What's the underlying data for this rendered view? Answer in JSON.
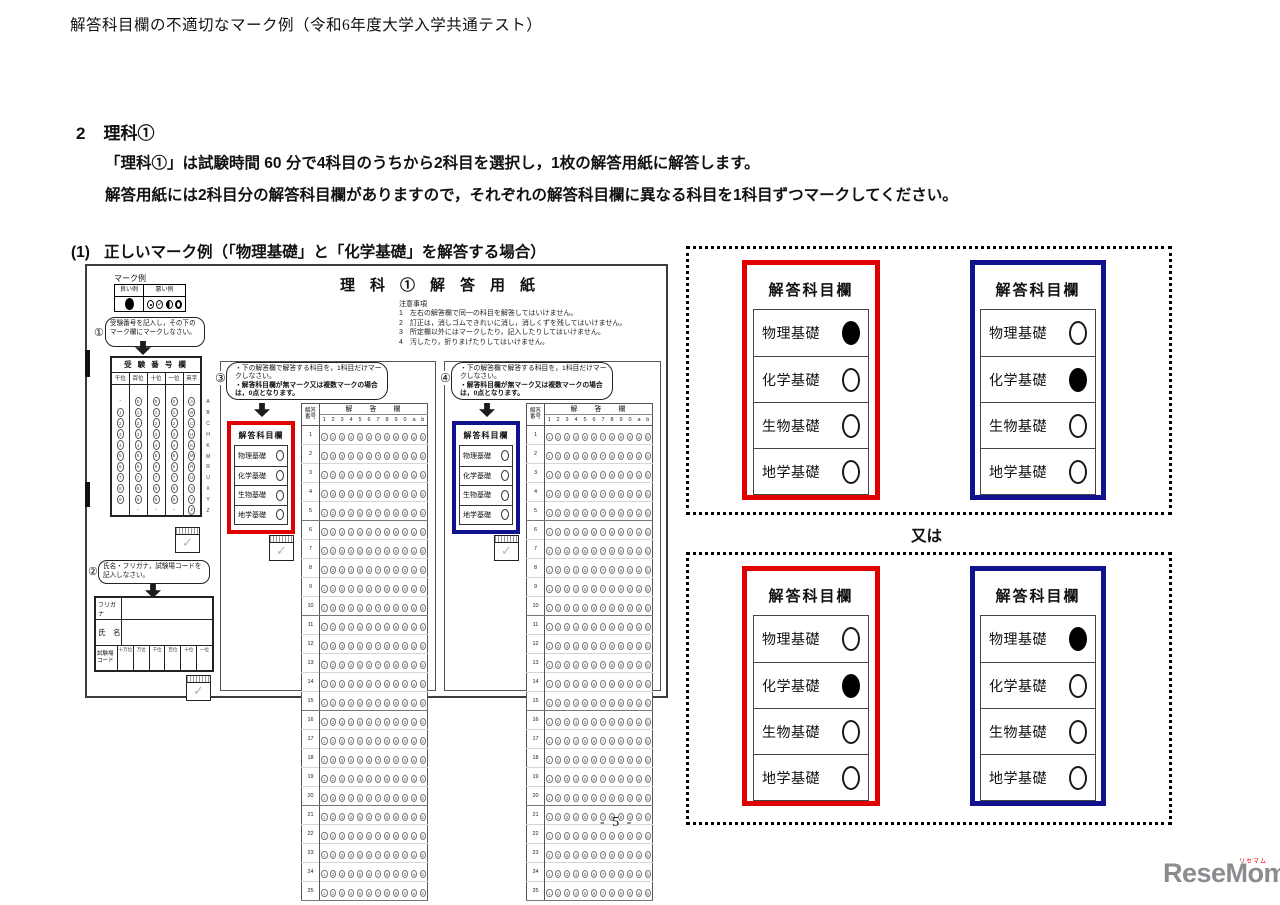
{
  "colors": {
    "red": "#e00000",
    "navy": "#10128e"
  },
  "page": {
    "header_title": "解答科目欄の不適切なマーク例（令和6年度大学入学共通テスト）",
    "section_number": "2",
    "section_title": "理科①",
    "para1": "「理科①」は試験時間 60 分で4科目のうちから2科目を選択し，1枚の解答用紙に解答します。",
    "para2": "解答用紙には2科目分の解答科目欄がありますので，それぞれの解答科目欄に異なる科目を1科目ずつマークしてください。",
    "example_number": "(1)",
    "example_title": "正しいマーク例（「物理基礎」と「化学基礎」を解答する場合）",
    "or_label": "又は",
    "page_number": "- 5 -"
  },
  "subjects": {
    "labels": [
      "物理基礎",
      "化学基礎",
      "生物基礎",
      "地学基礎"
    ]
  },
  "panel_title": "解答科目欄",
  "right_panels": {
    "boxes": [
      {
        "red_marked": 0,
        "blue_marked": 1
      },
      {
        "red_marked": 1,
        "blue_marked": 0
      }
    ]
  },
  "sheet": {
    "title": "理　科　①　解　答　用　紙",
    "notes_title": "注意事項",
    "notes": [
      "1　左右の解答欄で同一の科目を解答してはいけません。",
      "2　訂正は，消しゴムできれいに消し，消しくずを残してはいけません。",
      "3　所定欄以外にはマークしたり，記入したりしてはいけません。",
      "4　汚したり，折りまげたりしてはいけません。"
    ],
    "mark_example": {
      "title": "マーク例",
      "good": "良い例",
      "bad": "悪い例"
    },
    "step1": {
      "num": "①",
      "text": "受験番号を記入し，その下のマーク欄にマークしなさい。"
    },
    "step2": {
      "num": "②",
      "text": "氏名・フリガナ，試験場コードを記入しなさい。"
    },
    "step3_num": "③",
    "step4_num": "④",
    "step34_line1": "・下の解答欄で解答する科目を，1科目だけマークしなさい。",
    "step34_line2": "・解答科目欄が無マーク又は複数マークの場合は，0点となります。",
    "exam_table": {
      "title": "受 験 番 号 欄",
      "headers": [
        "千位",
        "百位",
        "十位",
        "一位",
        "英字"
      ],
      "columns": [
        [
          "-",
          "1",
          "2",
          "3",
          "4",
          "5",
          "6",
          "7",
          "8",
          "9",
          ""
        ],
        [
          "0",
          "1",
          "2",
          "3",
          "4",
          "5",
          "6",
          "7",
          "8",
          "9",
          "-"
        ],
        [
          "0",
          "1",
          "2",
          "3",
          "4",
          "5",
          "6",
          "7",
          "8",
          "9",
          "-"
        ],
        [
          "0",
          "1",
          "2",
          "3",
          "4",
          "5",
          "6",
          "7",
          "8",
          "9",
          "-"
        ],
        [
          "A",
          "B",
          "C",
          "H",
          "K",
          "M",
          "R",
          "U",
          "X",
          "Y",
          "Z"
        ]
      ],
      "side_letters": [
        "A",
        "B",
        "C",
        "H",
        "K",
        "M",
        "R",
        "U",
        "X",
        "Y",
        "Z"
      ]
    },
    "name_box": {
      "furigana": "フリガナ",
      "name": "氏　名",
      "code_line1": "試験場",
      "code_line2": "コード",
      "code_headers": [
        "十万位",
        "万位",
        "千位",
        "百位",
        "十位",
        "一位"
      ]
    },
    "answer_grid": {
      "corner_line1": "解答",
      "corner_line2": "番号",
      "header": "解　　答　　欄",
      "col_labels": [
        "1",
        "2",
        "3",
        "4",
        "5",
        "6",
        "7",
        "8",
        "9",
        "0",
        "a",
        "b"
      ],
      "row_count": 25
    }
  },
  "icons": {
    "check": "✓"
  },
  "logo": {
    "text": "ReseMom.",
    "ruby": "リセマム"
  }
}
